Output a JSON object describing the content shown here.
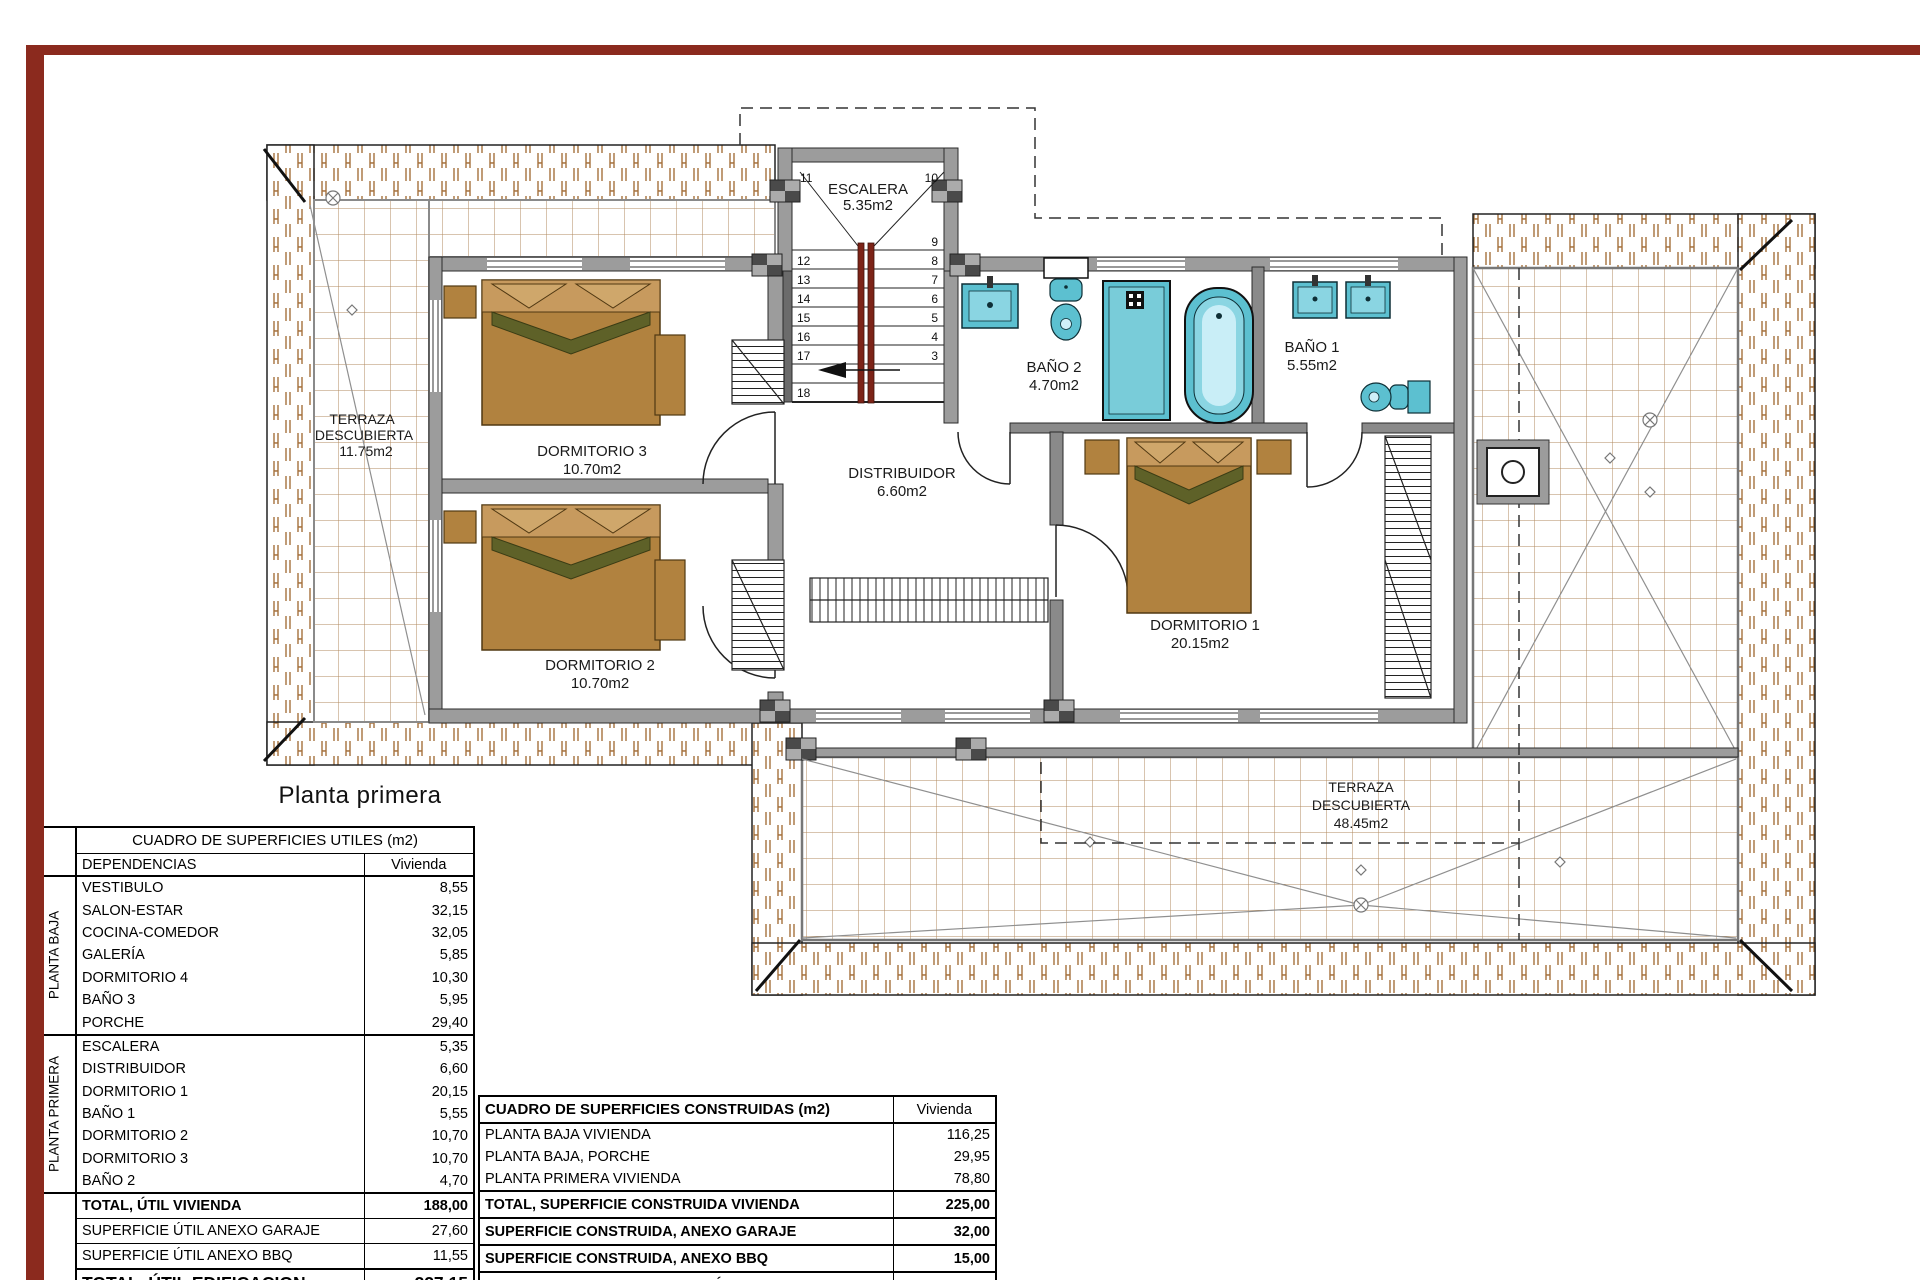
{
  "page": {
    "title": "Planta primera",
    "border_color": "#8b2a1e"
  },
  "plan": {
    "labels": {
      "escalera_name": "ESCALERA",
      "escalera_area": "5.35m2",
      "bano2_name": "BAÑO 2",
      "bano2_area": "4.70m2",
      "bano1_name": "BAÑO 1",
      "bano1_area": "5.55m2",
      "dorm3_name": "DORMITORIO 3",
      "dorm3_area": "10.70m2",
      "dorm2_name": "DORMITORIO 2",
      "dorm2_area": "10.70m2",
      "dorm1_name": "DORMITORIO 1",
      "dorm1_area": "20.15m2",
      "distribuidor_name": "DISTRIBUIDOR",
      "distribuidor_area": "6.60m2",
      "terraza_izq_line1": "TERRAZA",
      "terraza_izq_line2": "DESCUBIERTA",
      "terraza_izq_area": "11.75m2",
      "terraza_inf_line1": "TERRAZA",
      "terraza_inf_line2": "DESCUBIERTA",
      "terraza_inf_area": "48.45m2"
    },
    "stair_left": [
      "11",
      "12",
      "13",
      "14",
      "15",
      "16",
      "17",
      "18"
    ],
    "stair_right": [
      "10",
      "9",
      "8",
      "7",
      "6",
      "5",
      "4",
      "3"
    ],
    "colors": {
      "fixture_teal": "#5cc0d0",
      "bed_brown": "#b1823f",
      "tile_brown": "#a5713d",
      "wall_gray": "#9c9c9c",
      "stair_rail_red": "#7c2317"
    }
  },
  "tables": {
    "utiles": {
      "title": "CUADRO DE SUPERFICIES UTILES (m2)",
      "col_dependencias": "DEPENDENCIAS",
      "col_vivienda": "Vivienda",
      "group_planta_baja": "PLANTA BAJA",
      "group_planta_primera": "PLANTA PRIMERA",
      "baja_rows": [
        {
          "label": "VESTIBULO",
          "value": "8,55"
        },
        {
          "label": "SALON-ESTAR",
          "value": "32,15"
        },
        {
          "label": "COCINA-COMEDOR",
          "value": "32,05"
        },
        {
          "label": "GALERÍA",
          "value": "5,85"
        },
        {
          "label": "DORMITORIO 4",
          "value": "10,30"
        },
        {
          "label": "BAÑO 3",
          "value": "5,95"
        },
        {
          "label": "PORCHE",
          "value": "29,40"
        }
      ],
      "primera_rows": [
        {
          "label": "ESCALERA",
          "value": "5,35"
        },
        {
          "label": "DISTRIBUIDOR",
          "value": "6,60"
        },
        {
          "label": "DORMITORIO 1",
          "value": "20,15"
        },
        {
          "label": "BAÑO 1",
          "value": "5,55"
        },
        {
          "label": "DORMITORIO 2",
          "value": "10,70"
        },
        {
          "label": "DORMITORIO 3",
          "value": "10,70"
        },
        {
          "label": "BAÑO 2",
          "value": "4,70"
        }
      ],
      "total_vivienda": {
        "label": "TOTAL, ÚTIL VIVIENDA",
        "value": "188,00"
      },
      "anexo_garaje": {
        "label": "SUPERFICIE ÚTIL ANEXO GARAJE",
        "value": "27,60"
      },
      "anexo_bbq": {
        "label": "SUPERFICIE ÚTIL ANEXO BBQ",
        "value": "11,55"
      },
      "total_edificacion": {
        "label": "TOTAL, ÚTIL EDIFICACION",
        "value": "227,15"
      }
    },
    "construidas": {
      "title": "CUADRO DE SUPERFICIES CONSTRUIDAS (m2)",
      "col_vivienda": "Vivienda",
      "rows": [
        {
          "label": "PLANTA BAJA VIVIENDA",
          "value": "116,25"
        },
        {
          "label": "PLANTA BAJA, PORCHE",
          "value": "29,95"
        },
        {
          "label": "PLANTA PRIMERA VIVIENDA",
          "value": "78,80"
        }
      ],
      "total_vivienda": {
        "label": "TOTAL, SUPERFICIE CONSTRUIDA VIVIENDA",
        "value": "225,00"
      },
      "anexo_garaje": {
        "label": "SUPERFICIE CONSTRUIDA, ANEXO GARAJE",
        "value": "32,00"
      },
      "anexo_bbq": {
        "label": "SUPERFICIE CONSTRUIDA, ANEXO BBQ",
        "value": "15,00"
      },
      "total_edificacion": {
        "label": "TOTAL, CONSTRUIDA EDIFICACIÓN",
        "value": "272,00"
      }
    }
  }
}
